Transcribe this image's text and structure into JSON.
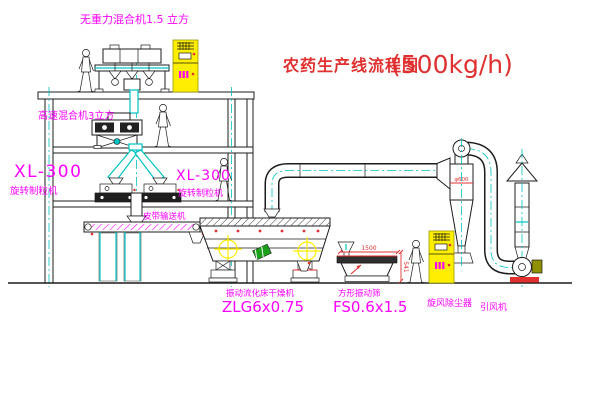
{
  "title": {
    "name": "农药生产线流程图",
    "capacity": "(500kg/h)"
  },
  "equipment_labels": {
    "gravity_mixer": "无重力混合机1.5 立方",
    "high_speed_mixer": "高速混合机3立方",
    "granulator_left_model": "XL-300",
    "granulator_left_name": "旋转制粒机",
    "granulator_right_model": "XL-300",
    "granulator_right_name": "旋转制粒机",
    "belt_conveyor": "皮带输送机",
    "dryer_name": "振动流化床干燥机",
    "dryer_model": "ZLG6x0.75",
    "sieve_name": "方形振动筛",
    "sieve_model": "FS0.6x1.5",
    "cyclone": "旋风除尘器",
    "fan": "引风机"
  },
  "dimensions": {
    "sieve_length": "1500",
    "sieve_height": "541",
    "cyclone_diameter": "φ600"
  },
  "colors": {
    "paper": "#ffffff",
    "line": "#1c1c1c",
    "cyan": "#00c3c3",
    "magenta": "#ff00ff",
    "red": "#e03030",
    "yellow": "#ffee00",
    "olive": "#8f8f00",
    "green": "#1ca01c"
  }
}
